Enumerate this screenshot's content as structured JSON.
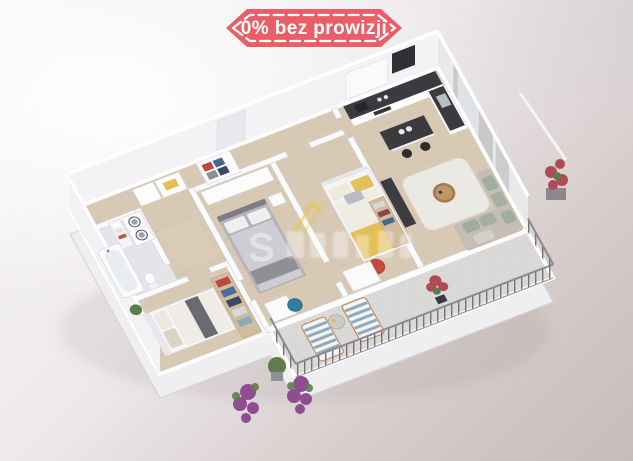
{
  "badge": {
    "label": "0% bez prowizji",
    "fill": "#ea5e68",
    "border": "#ffffff",
    "text_color": "#ffffff"
  },
  "watermark": {
    "letter": "S",
    "logo_color": "#e8c92e"
  },
  "scene": {
    "description": "isometric 3D render of an apartment floor plan with balcony"
  },
  "palette": {
    "background_top": "#f8f6f7",
    "background_bottom": "#c7bcb9",
    "wall": "#f3f2f4",
    "wall_cap": "#ffffff",
    "slab": "#efeef1",
    "floor_wood": "#d8c9b5",
    "floor_bath": "#e4e5e9",
    "floor_balcony": "#dad9d7",
    "counter_dark": "#3a3a3f",
    "sofa_base": "#c6beb4",
    "sofa_cushion": "#9fae9f",
    "bed_gray": "#cdced3",
    "accent_yellow": "#e3bf58",
    "armchair_red": "#c64a42",
    "chair_teal": "#2e7e9e",
    "coffee_table_wood": "#a57c4e",
    "wardrobe_wood": "#d2bc9e",
    "lounger_stripe": "#8fa9bc",
    "lounger_frame": "#c08a5a",
    "flowers_purple": "#8e4d8f",
    "flowers_red": "#b04a55",
    "plant_green": "#5e7d4e",
    "railing": "#73737a",
    "curtain": "#c9c9cc"
  }
}
